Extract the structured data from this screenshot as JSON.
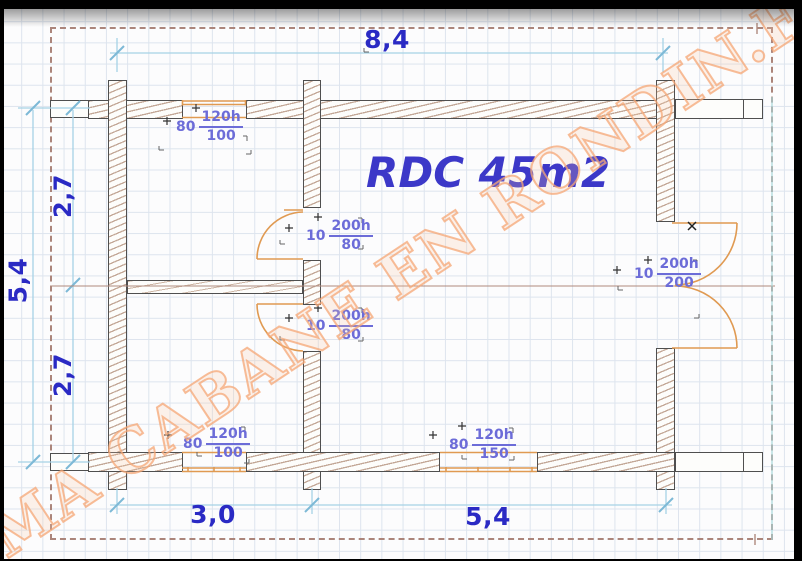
{
  "plan": {
    "title": "RDC 45m2",
    "watermark": "MA CABANE EN RONDIN.FR"
  },
  "dimensions": {
    "top": "8,4",
    "left_total": "5,4",
    "left_upper": "2,7",
    "left_lower": "2,7",
    "bottom_left": "3,0",
    "bottom_right": "5,4"
  },
  "openings": [
    {
      "name": "top-window",
      "sill": "80",
      "num": "120h",
      "den": "100"
    },
    {
      "name": "upper-interior-door",
      "sill": "10",
      "num": "200h",
      "den": "80"
    },
    {
      "name": "lower-interior-door",
      "sill": "10",
      "num": "200h",
      "den": "80"
    },
    {
      "name": "right-double-door",
      "sill": "10",
      "num": "200h",
      "den": "200"
    },
    {
      "name": "bottom-left-window",
      "sill": "80",
      "num": "120h",
      "den": "100"
    },
    {
      "name": "bottom-right-window",
      "sill": "80",
      "num": "120h",
      "den": "150"
    }
  ],
  "colors": {
    "dimension_text": "#2a2ac4",
    "annotation_text": "#6c6cd8",
    "title_text": "#3c38c8",
    "dimension_line": "#a6d2e6",
    "dimension_tick": "#7db9d6",
    "wall_hatch": "#c3a897",
    "wall_outline": "#4f4f4f",
    "opening_orange": "#e09a52",
    "dashed_border": "#ab857b",
    "axis_line": "#b08a7d",
    "watermark_orange": "#f5a775",
    "grid_line": "#dde4ee"
  }
}
